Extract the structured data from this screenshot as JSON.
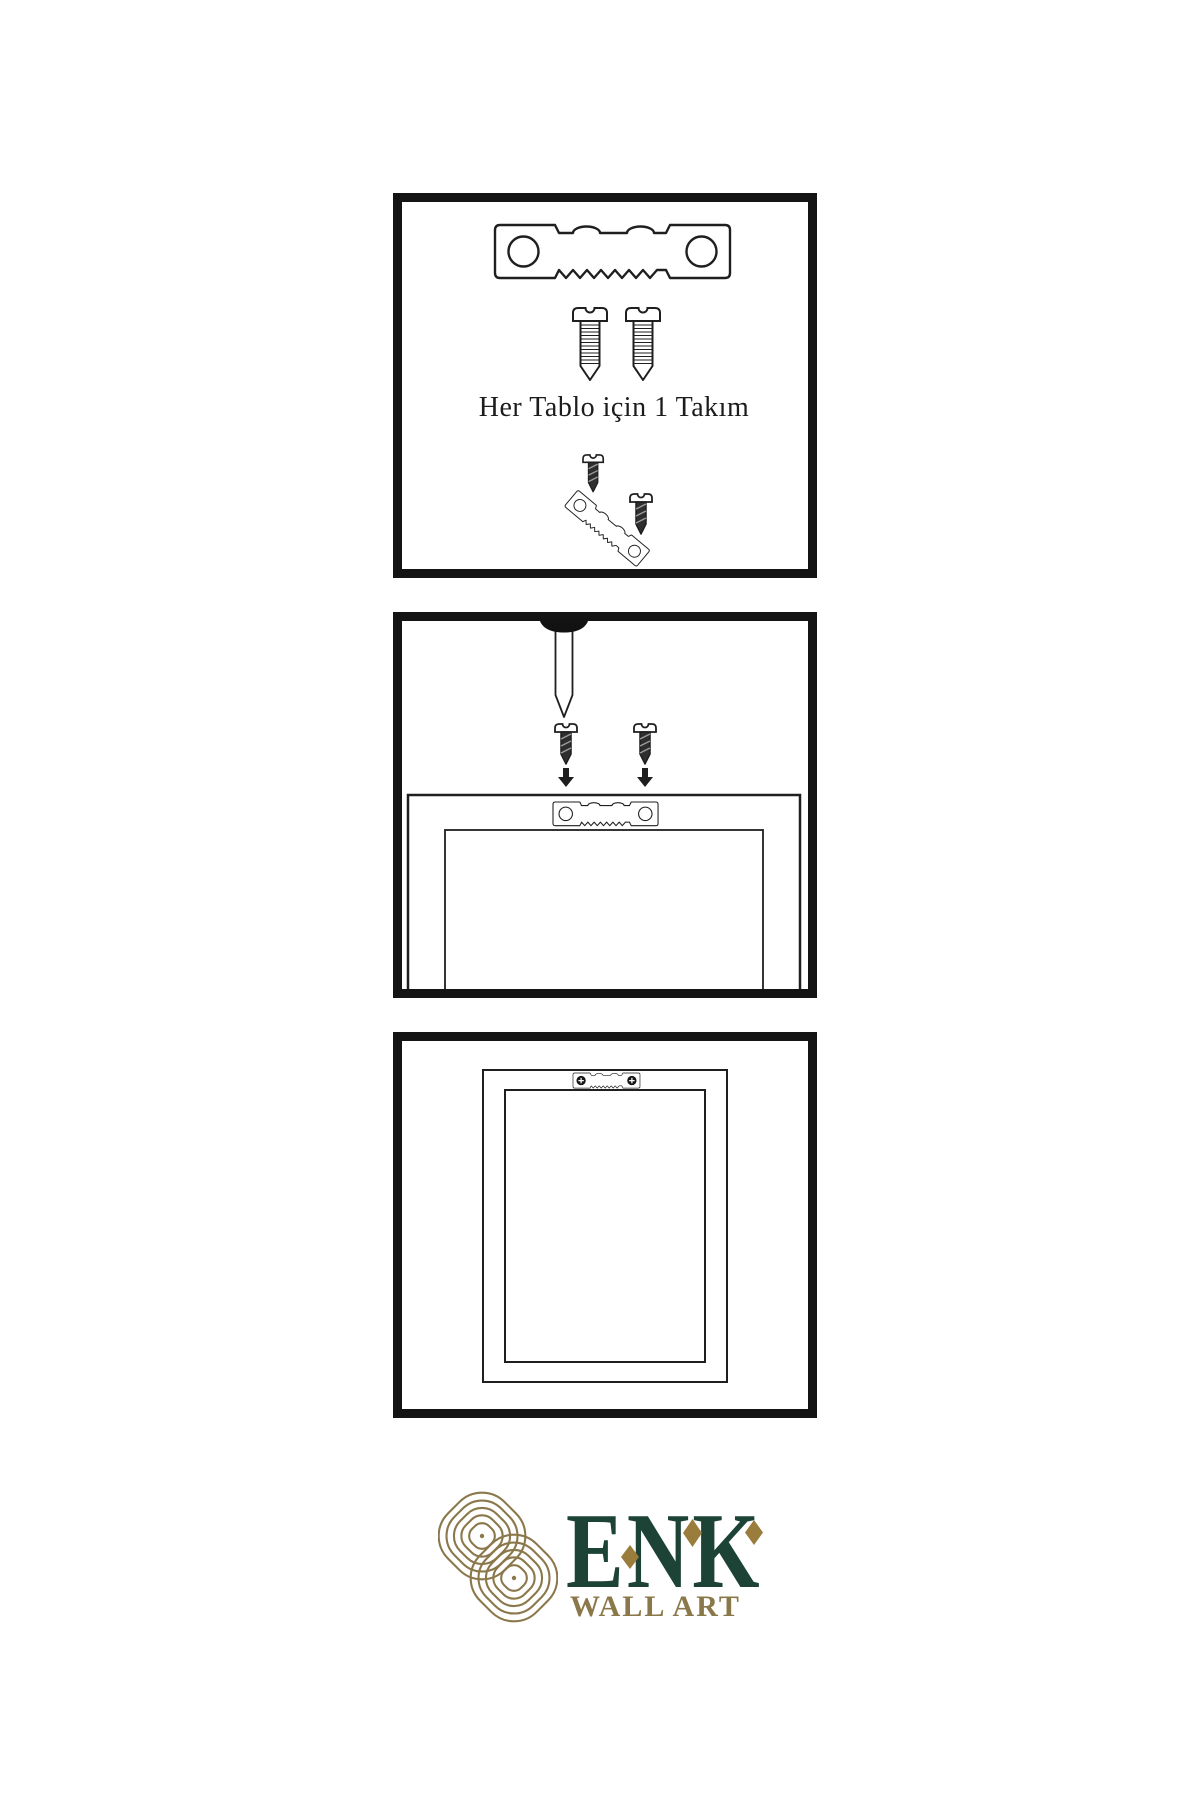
{
  "colors": {
    "panel_border": "#141414",
    "line": "#1f1f1f",
    "screw_dark": "#2e2e2e",
    "brand_green": "#1d4236",
    "brand_gold": "#8b784a",
    "diamond_gold": "#9a7c3c"
  },
  "step1": {
    "caption": "Her Tablo için 1 Takım",
    "icons": [
      "sawtooth-hanger-icon",
      "mounting-screw-icon",
      "mounting-screw-icon",
      "small-dark-screw-icon",
      "angled-sawtooth-hanger-icon",
      "dark-screw-icon"
    ]
  },
  "step2": {
    "icons": [
      "wall-nail-icon",
      "dark-screw-icon",
      "dark-screw-icon",
      "down-arrow-icon",
      "down-arrow-icon",
      "frame-back-outline",
      "sawtooth-hanger-icon"
    ]
  },
  "step3": {
    "icons": [
      "hung-frame-outline",
      "installed-sawtooth-hanger-icon",
      "phillips-screw-head-icon",
      "phillips-screw-head-icon"
    ]
  },
  "logo": {
    "brand": "ENK",
    "subtitle": "WALL ART"
  }
}
